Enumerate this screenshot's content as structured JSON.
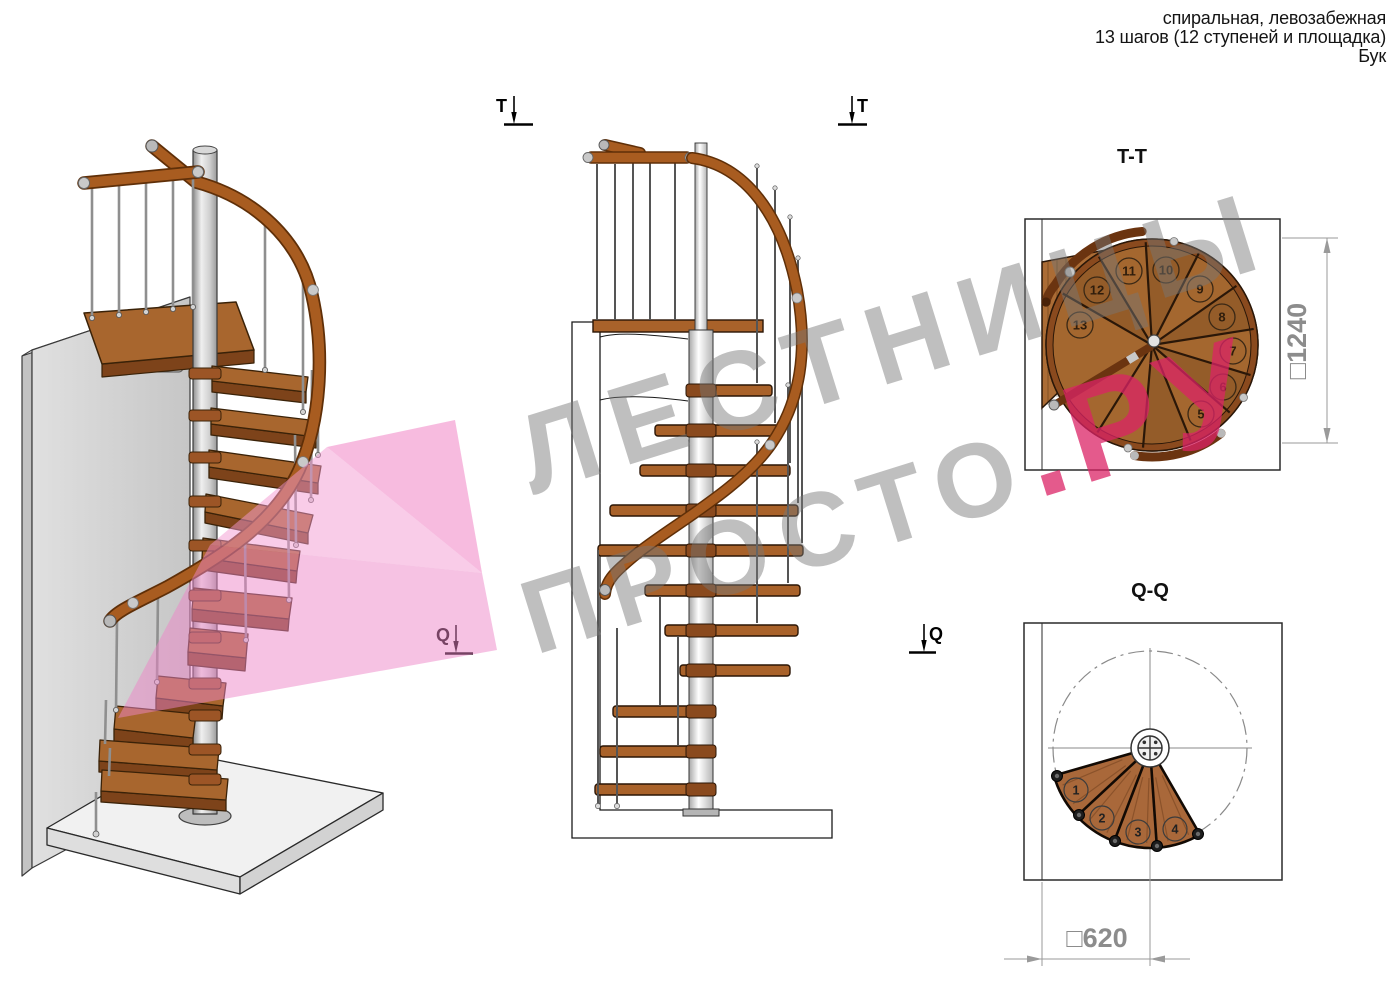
{
  "header": {
    "line1": "спиральная, левозабежная",
    "line2": "13 шагов (12 ступеней и площадка)",
    "line3": "Бук"
  },
  "markers": {
    "t": "T",
    "q": "Q"
  },
  "views": {
    "tt": {
      "title": "T-T",
      "steps": [
        "5",
        "6",
        "7",
        "8",
        "9",
        "10",
        "11",
        "12",
        "13"
      ],
      "dim_label": "□1240",
      "dimension_mm": 1240
    },
    "qq": {
      "title": "Q-Q",
      "steps": [
        "1",
        "2",
        "3",
        "4"
      ],
      "dim_label": "□620",
      "dimension_mm": 620
    }
  },
  "watermark": {
    "line1": "ЛЕСТНИЦЫ",
    "line2": "ПРОСТО",
    "suffix": ".РУ"
  },
  "colors": {
    "wood_top": "#a8662e",
    "wood_edge": "#7d431a",
    "handrail": "#a85c20",
    "handrail_dark": "#5f2f08",
    "pole": "#c9c9c9",
    "wall": "#d6d6d6",
    "pink_watermark": "#f078c0",
    "gray_watermark": "#767676",
    "red_watermark": "#db2365",
    "dim_gray": "#8c8c8c"
  }
}
